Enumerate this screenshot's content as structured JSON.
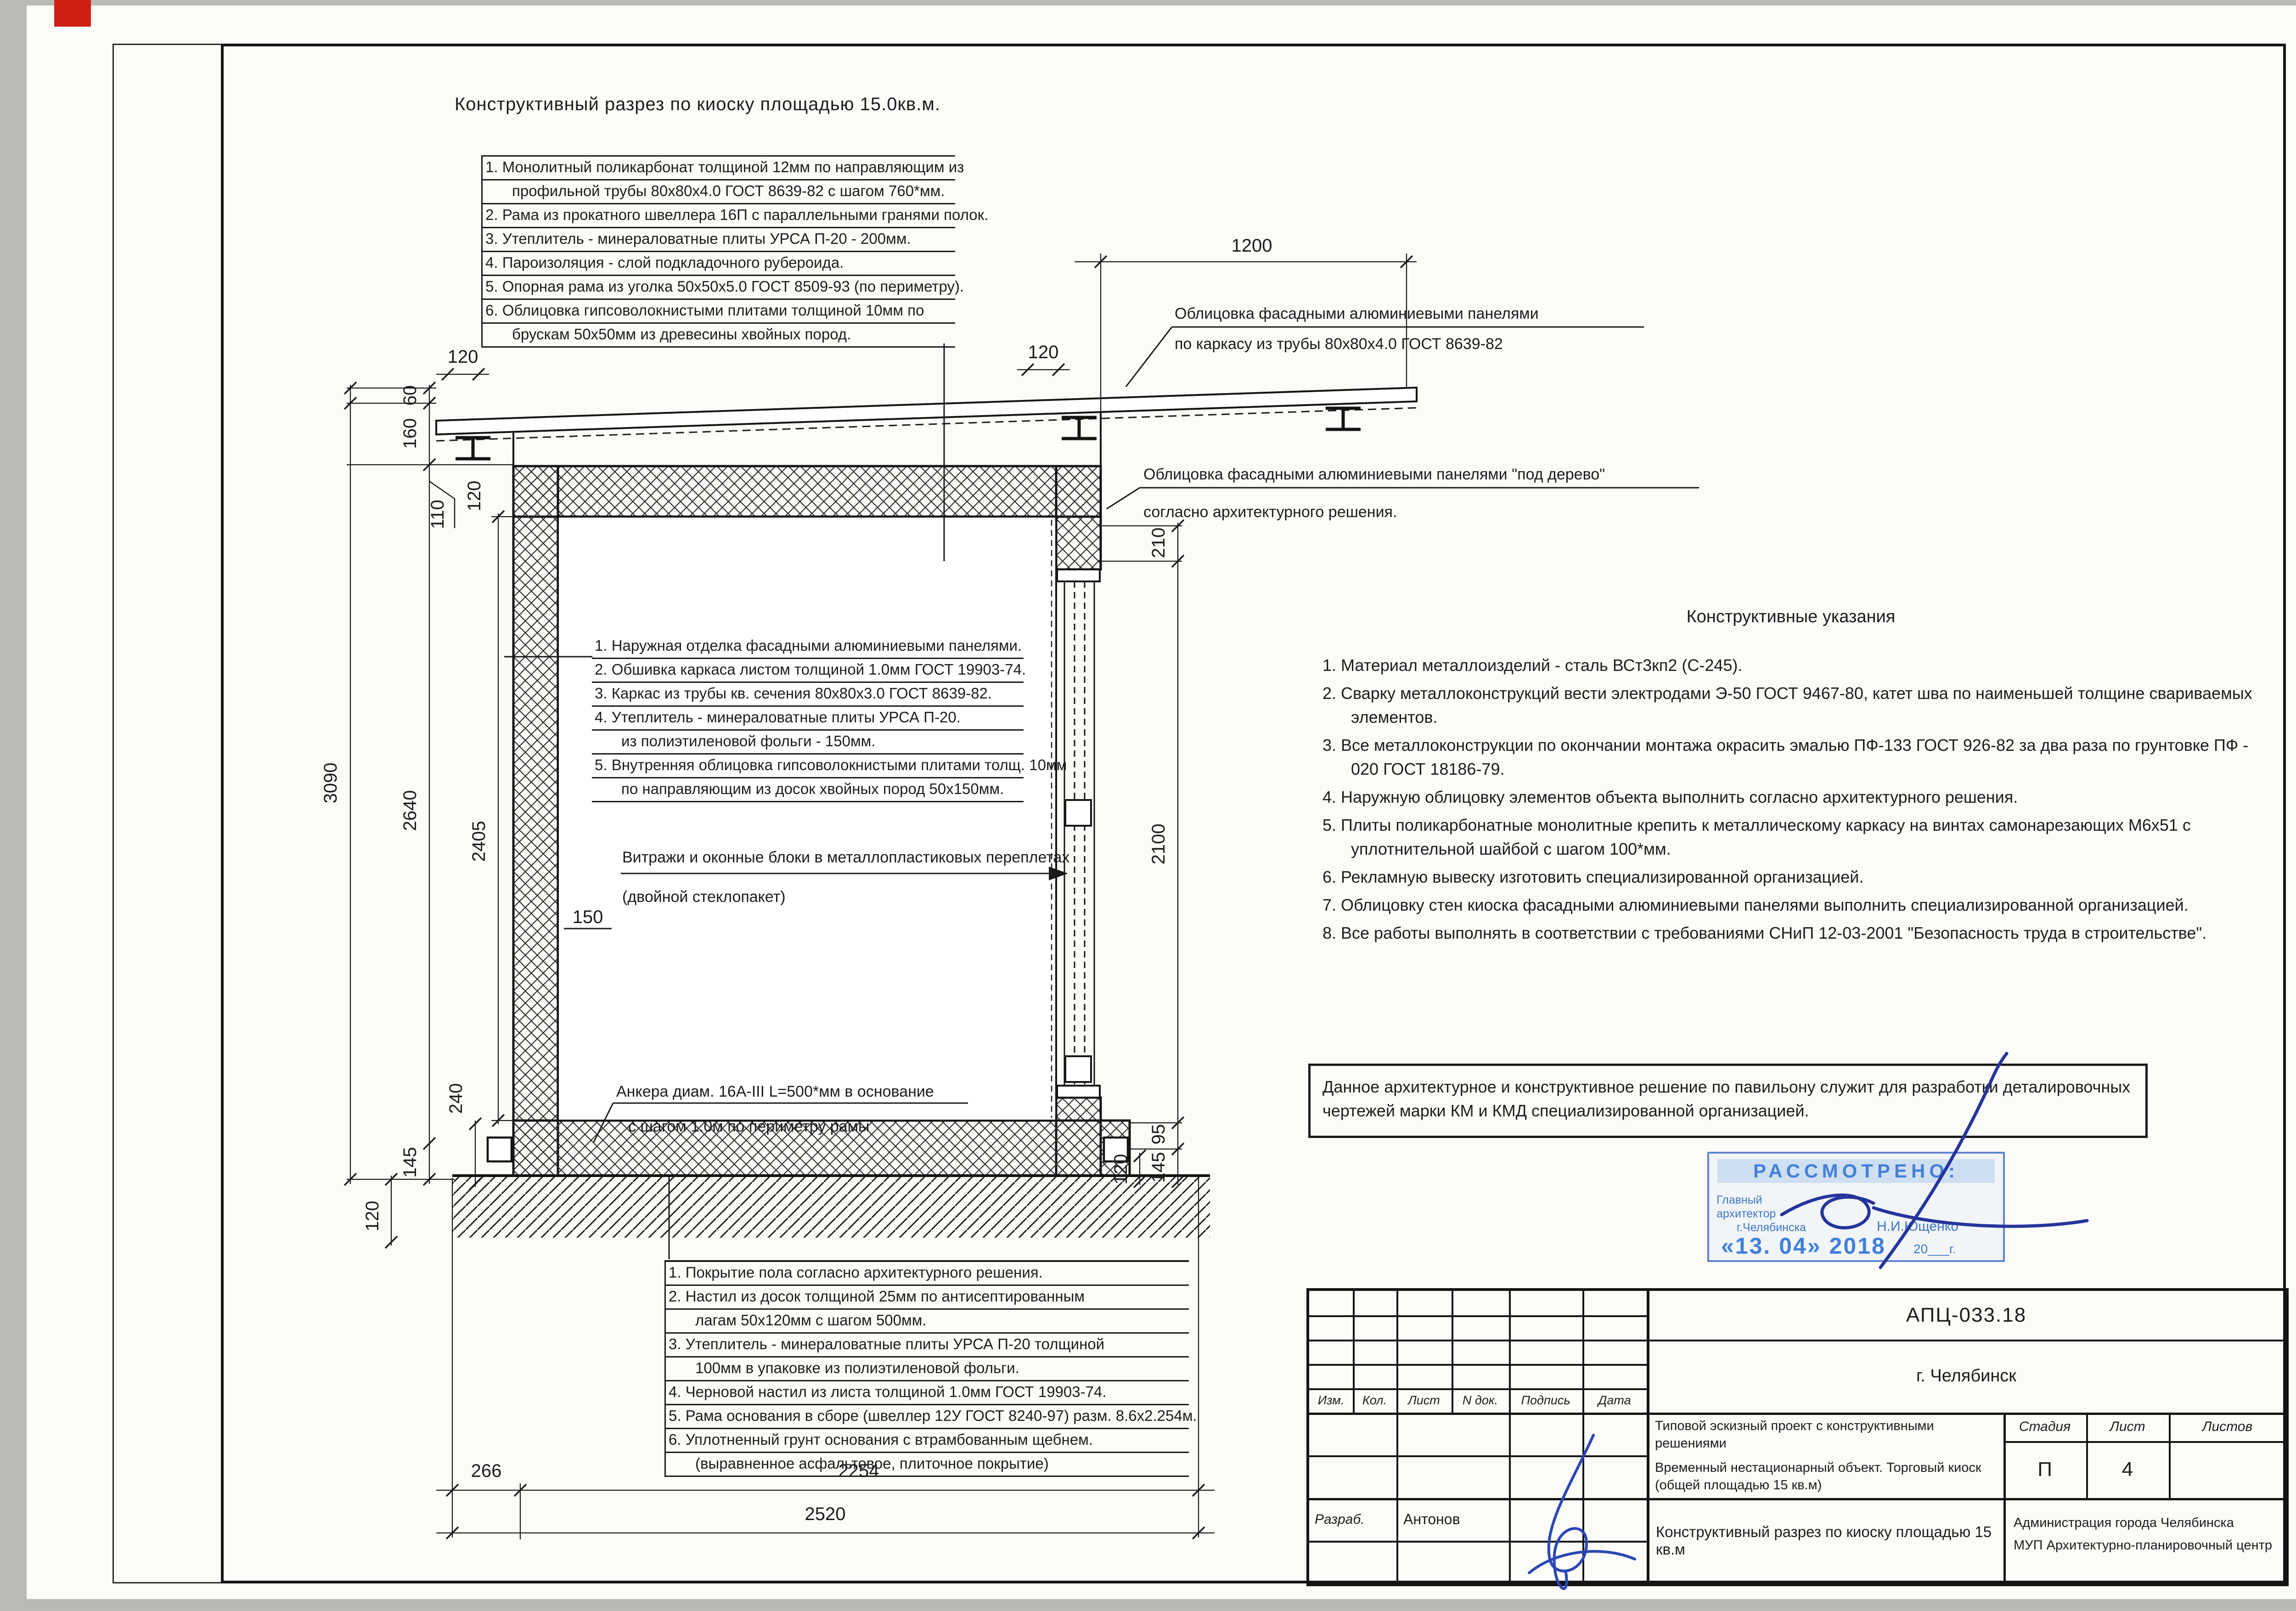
{
  "sheet": {
    "title": "Конструктивный разрез по киоску площадью 15.0кв.м.",
    "note_box": "Данное архитектурное и конструктивное решение по павильону служит для разработки деталировочных чертежей марки КМ и КМД специализированной организацией."
  },
  "roof_notes": [
    "1. Монолитный поликарбонат толщиной 12мм по направляющим из",
    "профильной трубы 80х80х4.0 ГОСТ 8639-82 с шагом 760*мм.",
    "2. Рама из прокатного швеллера 16П с параллельными гранями полок.",
    "3. Утеплитель - минераловатные плиты УРСА П-20 - 200мм.",
    "4. Пароизоляция - слой подкладочного рубероида.",
    "5. Опорная рама из уголка 50х50х5.0 ГОСТ 8509-93 (по периметру).",
    "6. Облицовка гипсоволокнистыми плитами толщиной 10мм по",
    "брускам 50х50мм из древесины хвойных пород."
  ],
  "wall_notes": [
    "1. Наружная отделка фасадными алюминиевыми панелями.",
    "2. Обшивка каркаса листом толщиной 1.0мм ГОСТ 19903-74.",
    "3. Каркас из трубы кв. сечения 80х80х3.0  ГОСТ 8639-82.",
    "4. Утеплитель - минераловатные плиты УРСА П-20.",
    "из полиэтиленовой фольги - 150мм.",
    "5. Внутренняя облицовка гипсоволокнистыми плитами толщ. 10мм",
    "по направляющим из досок хвойных пород 50х150мм."
  ],
  "floor_notes": [
    "1. Покрытие пола согласно архитектурного решения.",
    "2. Настил из досок толщиной 25мм по антисептированным",
    "лагам 50х120мм с шагом 500мм.",
    "3. Утеплитель - минераловатные плиты УРСА П-20 толщиной",
    "100мм в упаковке из полиэтиленовой фольги.",
    "4. Черновой настил из листа толщиной 1.0мм ГОСТ 19903-74.",
    "5. Рама основания в сборе (швеллер 12У ГОСТ 8240-97) разм. 8.6х2.254м.",
    "6. Уплотненный грунт основания с втрамбованным щебнем.",
    "(выравненное асфальтовое, плиточное покрытие)"
  ],
  "instructions": {
    "heading": "Конструктивные указания",
    "items": [
      "1. Материал металлоизделий - сталь ВСт3кп2 (С-245).",
      "2. Сварку металлоконструкций вести электродами Э-50 ГОСТ 9467-80, катет шва по наименьшей толщине свариваемых элементов.",
      "3. Все металлоконструкции по окончании монтажа окрасить эмалью ПФ-133 ГОСТ 926-82 за два раза по грунтовке ПФ - 020 ГОСТ 18186-79.",
      "4. Наружную облицовку элементов объекта выполнить согласно архитектурного решения.",
      "5. Плиты поликарбонатные монолитные крепить к металлическому каркасу на винтах самонарезающих М6х51 с уплотнительной шайбой с шагом 100*мм.",
      "6. Рекламную вывеску изготовить специализированной организацией.",
      "7. Облицовку стен киоска фасадными алюминиевыми панелями выполнить специализированной организацией.",
      "8. Все работы выполнять в соответствии с требованиями СНиП 12-03-2001 \"Безопасность труда в строительстве\"."
    ]
  },
  "callouts": {
    "facade_top": [
      "Облицовка фасадными алюминиевыми панелями",
      "по каркасу из трубы 80х80х4.0 ГОСТ 8639-82"
    ],
    "facade_wood": [
      "Облицовка фасадными алюминиевыми панелями \"под дерево\"",
      "согласно архитектурного решения."
    ],
    "windows": [
      "Витражи и оконные блоки в металлопластиковых переплетах",
      "(двойной стеклопакет)"
    ],
    "anchors": [
      "Анкера диам. 16А-III L=500*мм в основание",
      "с шагом 1.0м по периметру рамы"
    ]
  },
  "dims": {
    "v3090": "3090",
    "v2640": "2640",
    "v2405": "2405",
    "v60": "60",
    "v160": "160",
    "v110": "110",
    "v120_wall": "120",
    "v240": "240",
    "v145_left": "145",
    "v120_embed": "120",
    "v210": "210",
    "v2100": "2100",
    "v95": "95",
    "v145_right": "145",
    "v120_floor": "120",
    "v1200": "1200",
    "v120_roof_left": "120",
    "v120_roof_right": "120",
    "v266": "266",
    "v2254": "2254",
    "v2520": "2520",
    "v150": "150"
  },
  "stamp": {
    "title": "РАССМОТРЕНО:",
    "role1": "Главный",
    "role2": "архитектор",
    "role3": "г.Челябинска",
    "name": "Н.И.Ющенко",
    "date": "«13. 04» 2018",
    "year": "20___г."
  },
  "titleblock": {
    "doc_number": "АПЦ-033.18",
    "city": "г. Челябинск",
    "cols": [
      "Изм.",
      "Кол.",
      "Лист",
      "N док.",
      "Подпись",
      "Дата"
    ],
    "project1": "Типовой эскизный проект с конструктивными решениями",
    "project2": "Временный нестационарный объект. Торговый киоск",
    "project3": "(общей площадью 15 кв.м)",
    "stage_label": "Стадия",
    "sheet_label": "Лист",
    "sheets_label": "Листов",
    "stage": "П",
    "sheet_no": "4",
    "developer_label": "Разраб.",
    "developer": "Антонов",
    "sheet_title": "Конструктивный разрез по киоску площадью 15 кв.м",
    "org1": "Администрация города Челябинска",
    "org2": "МУП Архитектурно-планировочный центр"
  }
}
